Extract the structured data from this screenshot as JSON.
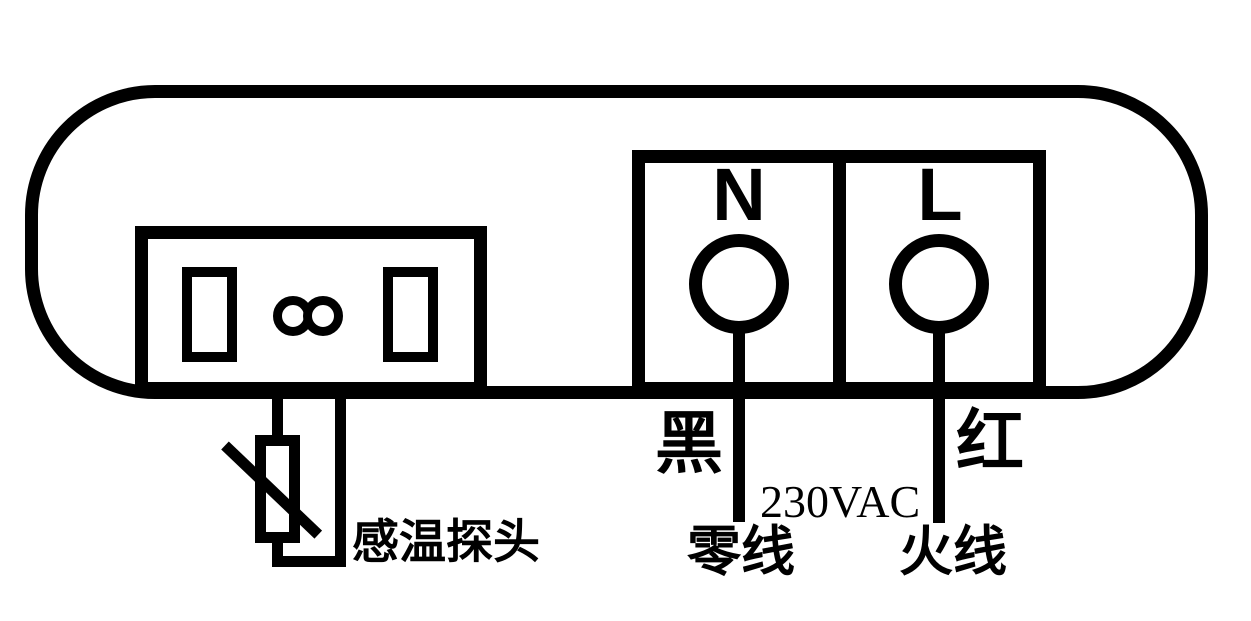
{
  "diagram": {
    "type": "wiring-diagram",
    "colors": {
      "line": "#000000",
      "background": "#ffffff"
    },
    "terminals": {
      "n": {
        "letter": "N",
        "wire_color_label": "黑",
        "wire_name": "零线"
      },
      "l": {
        "letter": "L",
        "wire_color_label": "红",
        "wire_name": "火线"
      }
    },
    "power": {
      "voltage": "230VAC"
    },
    "sensor": {
      "label": "感温探头",
      "symbol": "thermistor",
      "connector_symbol": "infinity"
    }
  }
}
